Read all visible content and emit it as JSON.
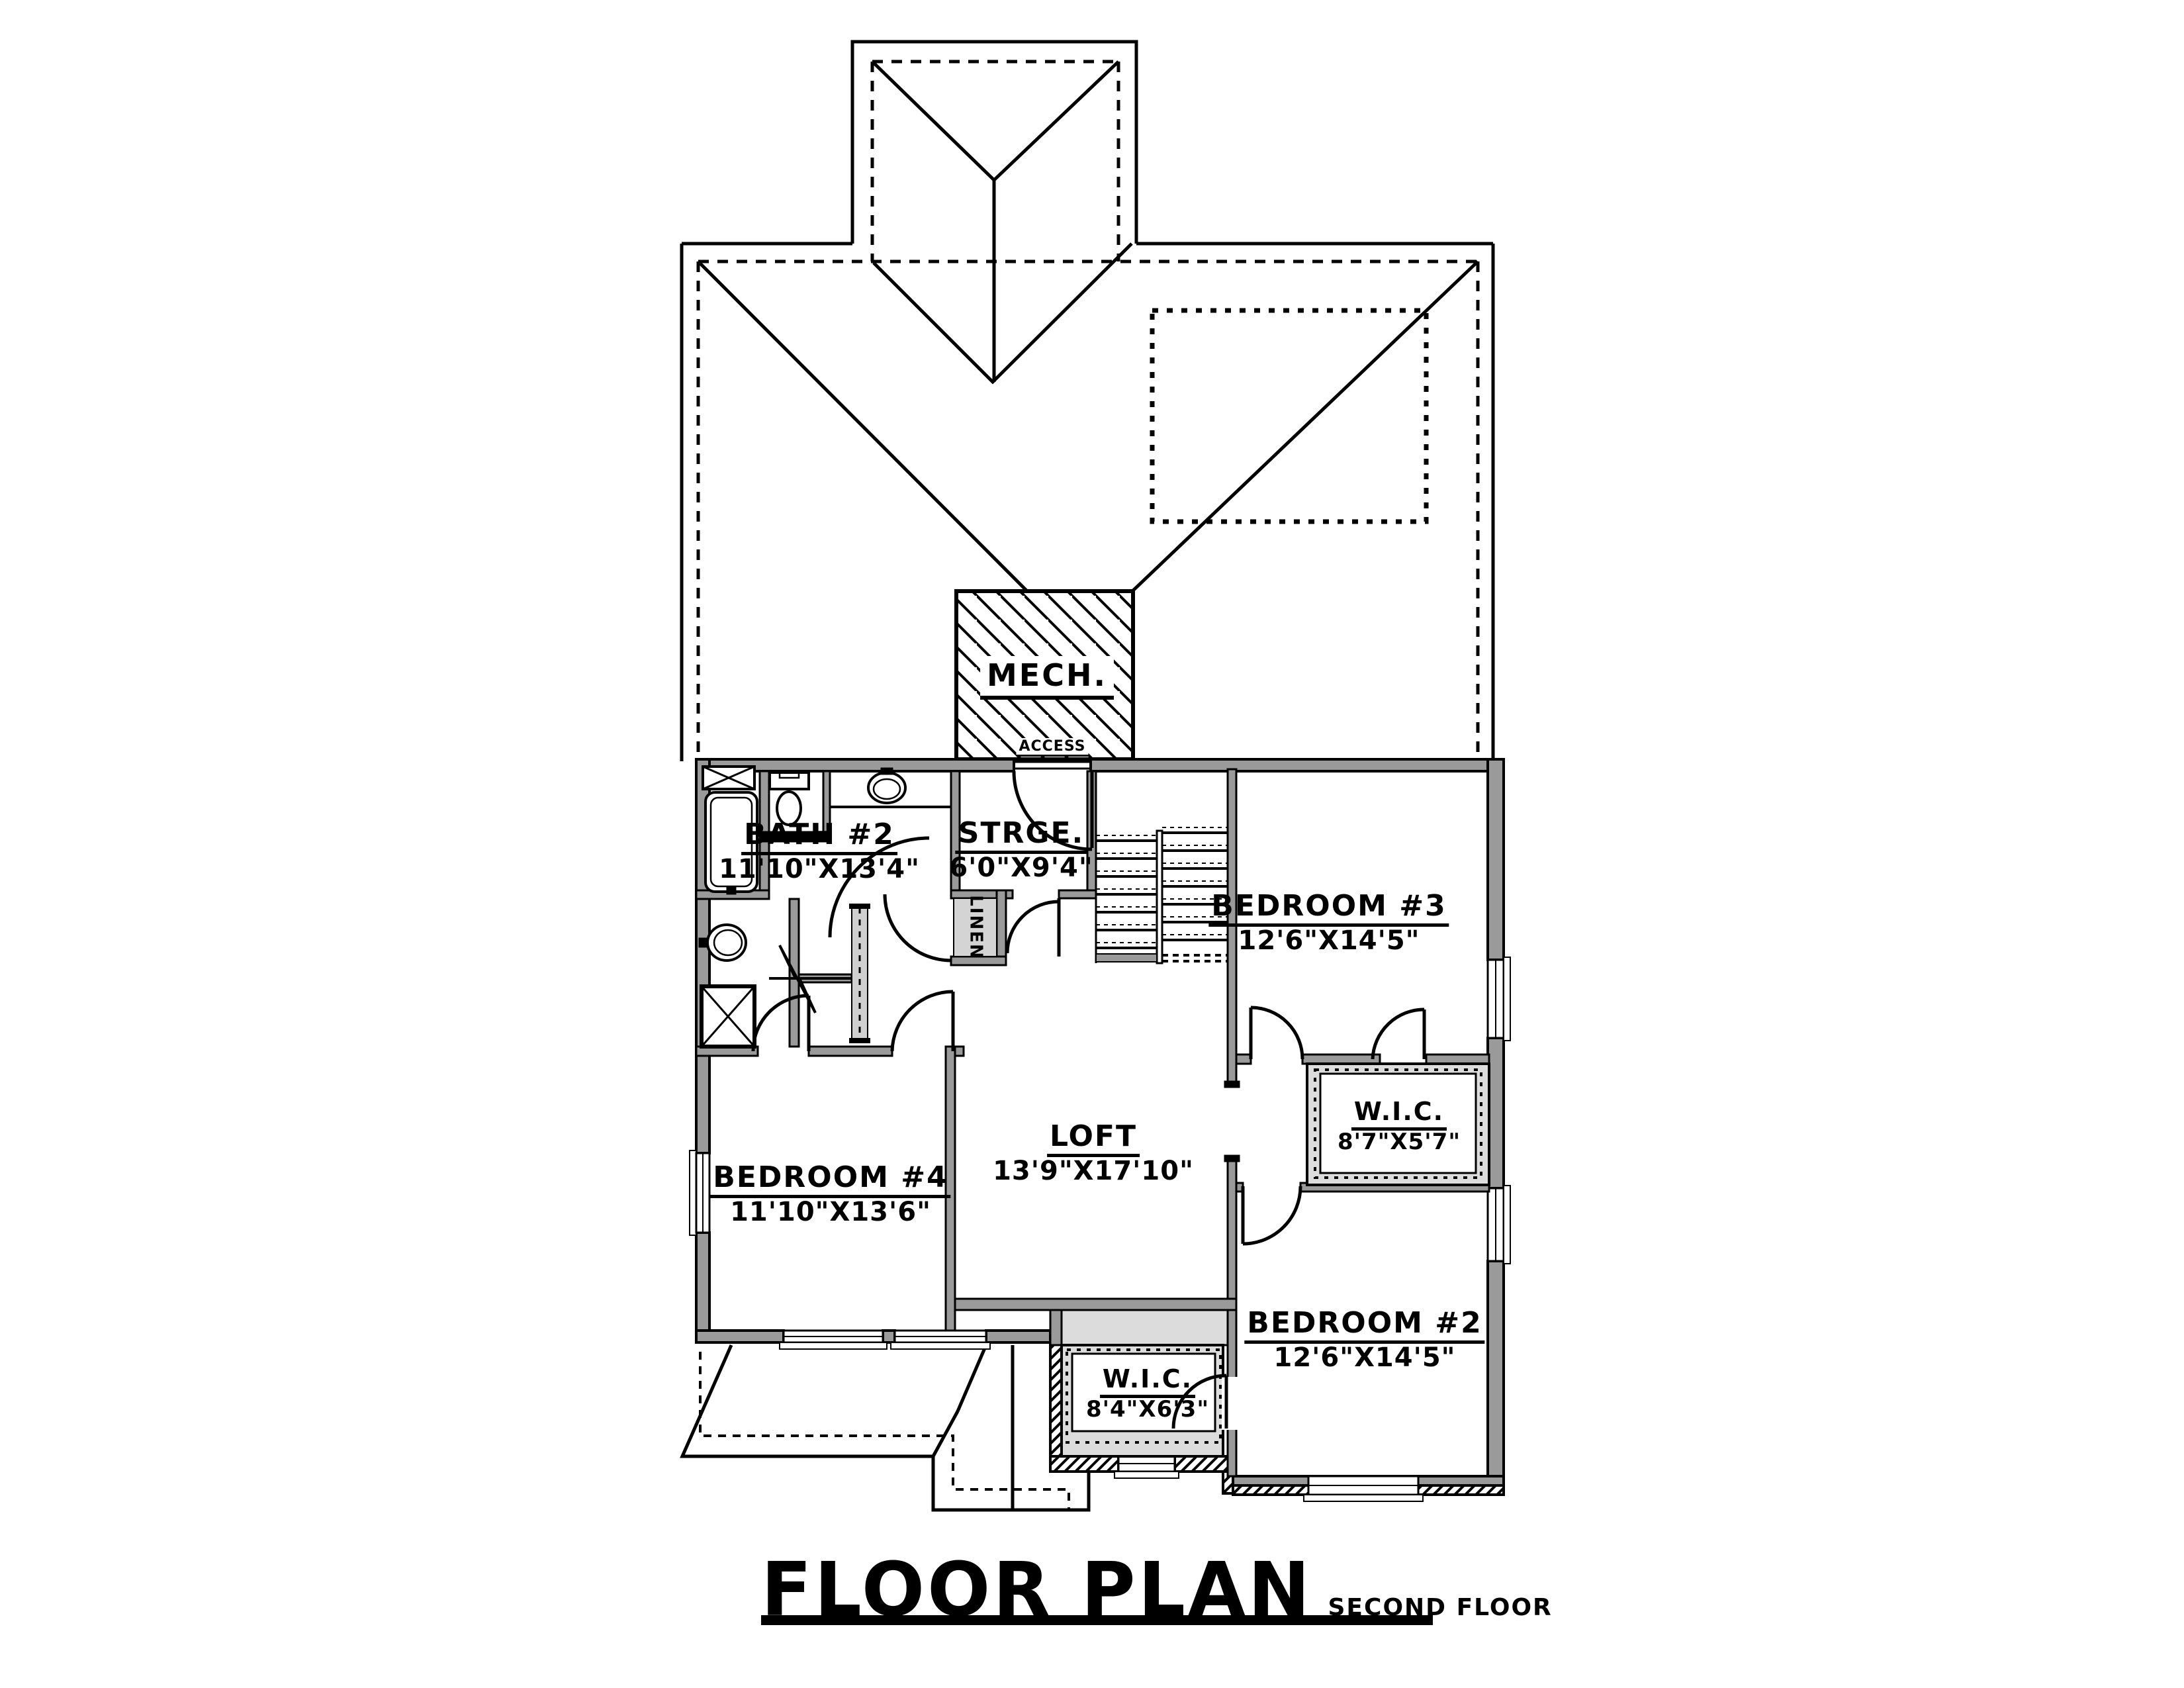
{
  "title": {
    "main": "FLOOR PLAN",
    "sub": "SECOND FLOOR"
  },
  "rooms": {
    "bath2": {
      "name": "BATH #2",
      "dims": "11'10\"X13'4\""
    },
    "strge": {
      "name": "STRGE.",
      "dims": "6'0\"X9'4\""
    },
    "bedroom3": {
      "name": "BEDROOM #3",
      "dims": "12'6\"X14'5\""
    },
    "wic3": {
      "name": "W.I.C.",
      "dims": "8'7\"X5'7\""
    },
    "loft": {
      "name": "LOFT",
      "dims": "13'9\"X17'10\""
    },
    "bedroom4": {
      "name": "BEDROOM #4",
      "dims": "11'10\"X13'6\""
    },
    "bedroom2": {
      "name": "BEDROOM #2",
      "dims": "12'6\"X14'5\""
    },
    "wic2": {
      "name": "W.I.C.",
      "dims": "8'4\"X6'3\""
    }
  },
  "labels": {
    "mech": "MECH.",
    "access": "ACCESS",
    "linen": "LINEN"
  },
  "colors": {
    "wall": "#9a9a9a",
    "line": "#000000",
    "closet_fill": "#dcdcdc",
    "paper": "#ffffff"
  }
}
